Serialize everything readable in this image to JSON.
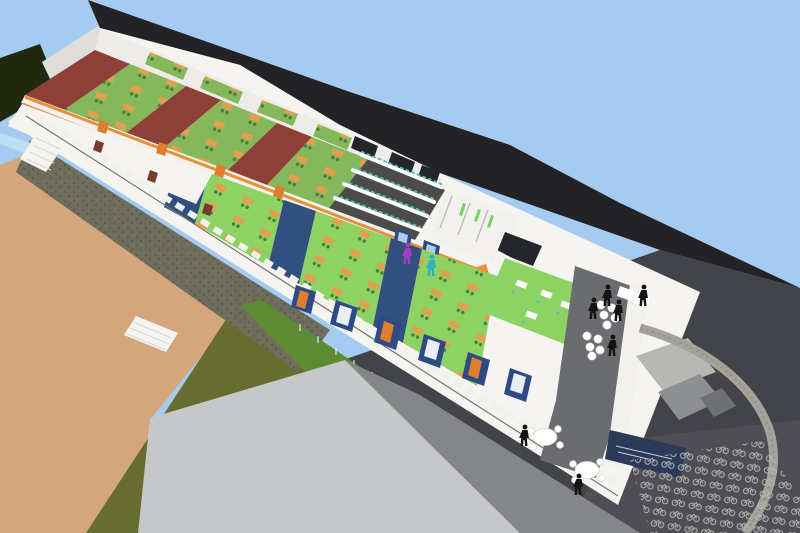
{
  "scene": {
    "kind": "aerial-3d-cutaway-architectural-model",
    "subject": "two-storey school building sectioned open showing classrooms, computer lab, toilets, staff room, terrace, schoolyard and bicycle parking",
    "counts": {
      "upper_floor_classrooms": 3,
      "ground_floor_classrooms": 3,
      "computer_lab_desk_rows": 4,
      "round_tables": 2,
      "stool_clusters": 2,
      "stools": 10,
      "people_silhouettes": 9
    }
  },
  "colors": {
    "sky": "#A6CBF0",
    "roof": "#232325",
    "asphalt": "#434449",
    "asphalt_light": "#54555A",
    "field_tan": "#D3A77B",
    "grass_olive": "#666D2E",
    "grass_bright": "#5E8A33",
    "gravel": "#6F6C5C",
    "gravel_dot": "#5B584A",
    "pavement": "#C6C7C9",
    "pavement_shadow": "#85868A",
    "building_white": "#F5F4F1",
    "wall_shade": "#E0DEDA",
    "backrow_white": "#EDECE8",
    "maroon": "#8E4038",
    "floor_green_upper": "#85B75B",
    "floor_green_ground": "#8CD364",
    "green_slit": "#7FCF6A",
    "divider_navy": "#31507F",
    "corridor_orange": "#E89038",
    "door_orange": "#DF7F2D",
    "desk_orange": "#E2A04E",
    "chair_green": "#45803A",
    "lab_floor": "#4B4B49",
    "monitor_teal": "#5BBFAD",
    "terrace_gray": "#6B6C6F",
    "parapet_white": "#F2F1EE",
    "stone_wall": "#A4A29A",
    "stone_wall_edge": "#8B897F",
    "sign_navy": "#2A3A58",
    "furniture_white": "#FFFFFF",
    "furniture_edge": "#D6D5D0",
    "figure_black": "#141414",
    "figure_purple": "#A040C0",
    "figure_teal": "#30B0C0",
    "window_dark": "#24262B",
    "window_blue": "#2E4A85",
    "water_blue": "#BCDFF4",
    "vegetation_dark": "#20290F",
    "canopy_light": "#B7B7B3",
    "canopy_mid": "#8E8F91",
    "canopy_dark": "#6F7073",
    "groove": "#77776F",
    "step_line": "#D9D8D3",
    "stall_gray": "#BDBCB8",
    "bike_gray": "#B4B5B1",
    "door_red": "#7A3A30",
    "sign_mark": "#E8EAF0"
  }
}
